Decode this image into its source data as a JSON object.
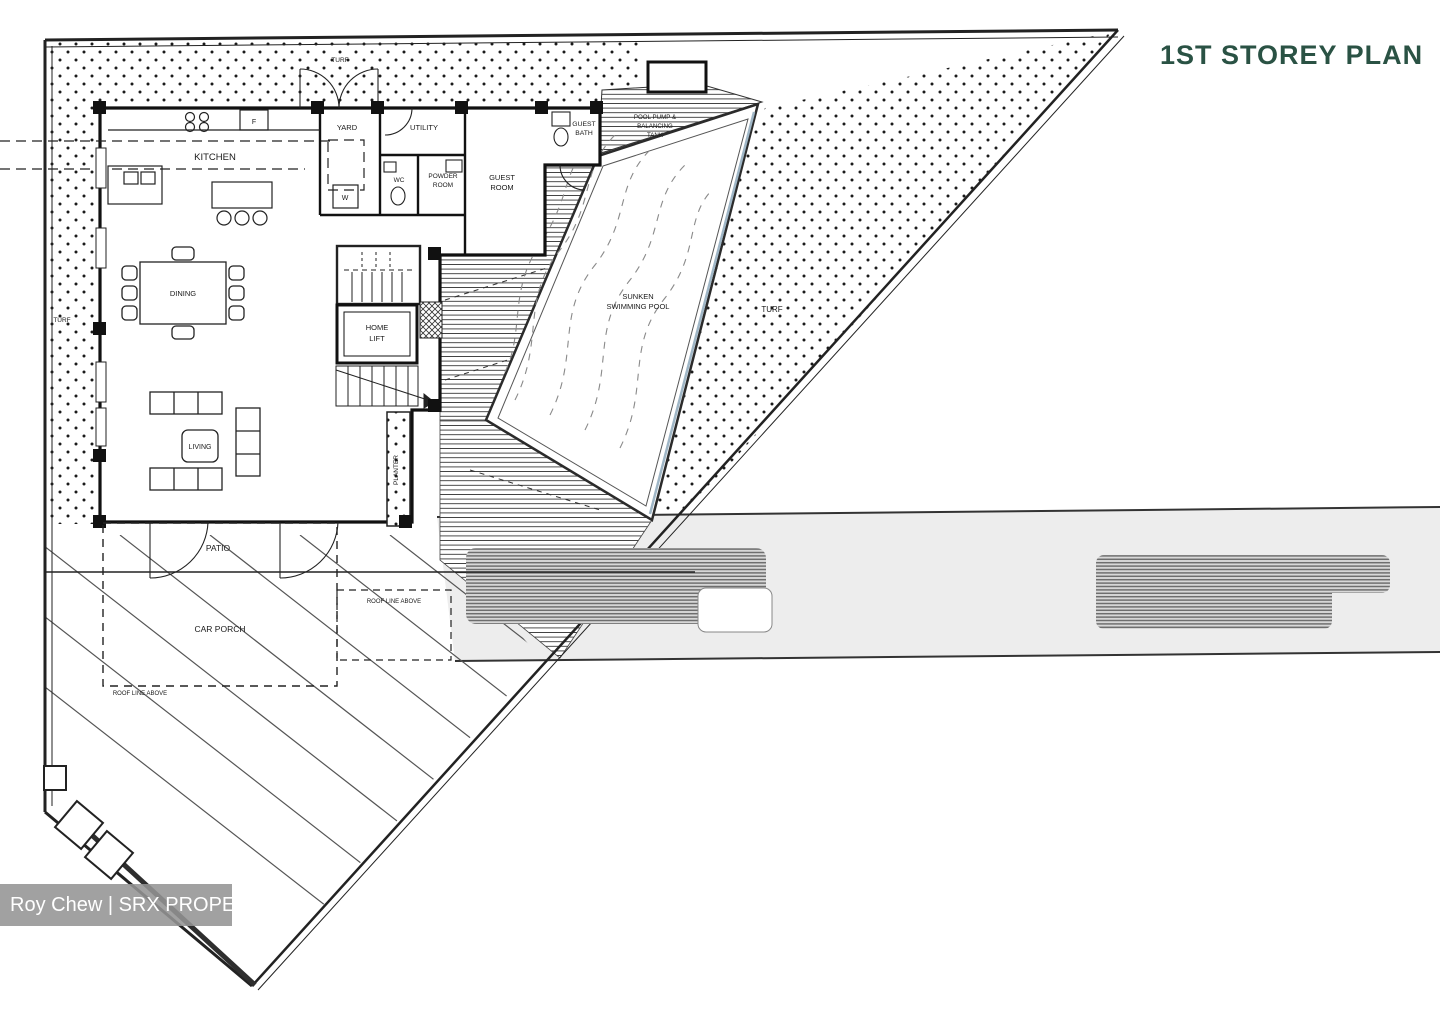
{
  "header": {
    "title": "1ST STOREY PLAN"
  },
  "watermark": {
    "text": "Roy Chew | SRX PROPERTY"
  },
  "colors": {
    "title": "#2a5244",
    "watermark_bg": "#949494",
    "line": "#1a1a1a",
    "road_fill": "#ededed",
    "pool_edge": "#9fb6c6"
  },
  "rooms": {
    "kitchen": "KITCHEN",
    "yard": "YARD",
    "utility": "UTILITY",
    "wc": "WC",
    "powder_room": [
      "POWDER",
      "ROOM"
    ],
    "guest_room": [
      "GUEST",
      "ROOM"
    ],
    "guest_bath": [
      "GUEST",
      "BATH"
    ],
    "dining": "DINING",
    "home_lift": [
      "HOME",
      "LIFT"
    ],
    "living": "LIVING",
    "patio": "PATIO",
    "car_porch": "CAR PORCH",
    "planter": "PLANTER",
    "pool": [
      "SUNKEN",
      "SWIMMING POOL"
    ],
    "pool_pump": [
      "POOL PUMP &",
      "BALANCING",
      "TANK"
    ]
  },
  "site_labels": {
    "turf": "TURF",
    "roof_line": "ROOF LINE ABOVE"
  },
  "appliances": {
    "fridge": "F",
    "washer": "W"
  }
}
